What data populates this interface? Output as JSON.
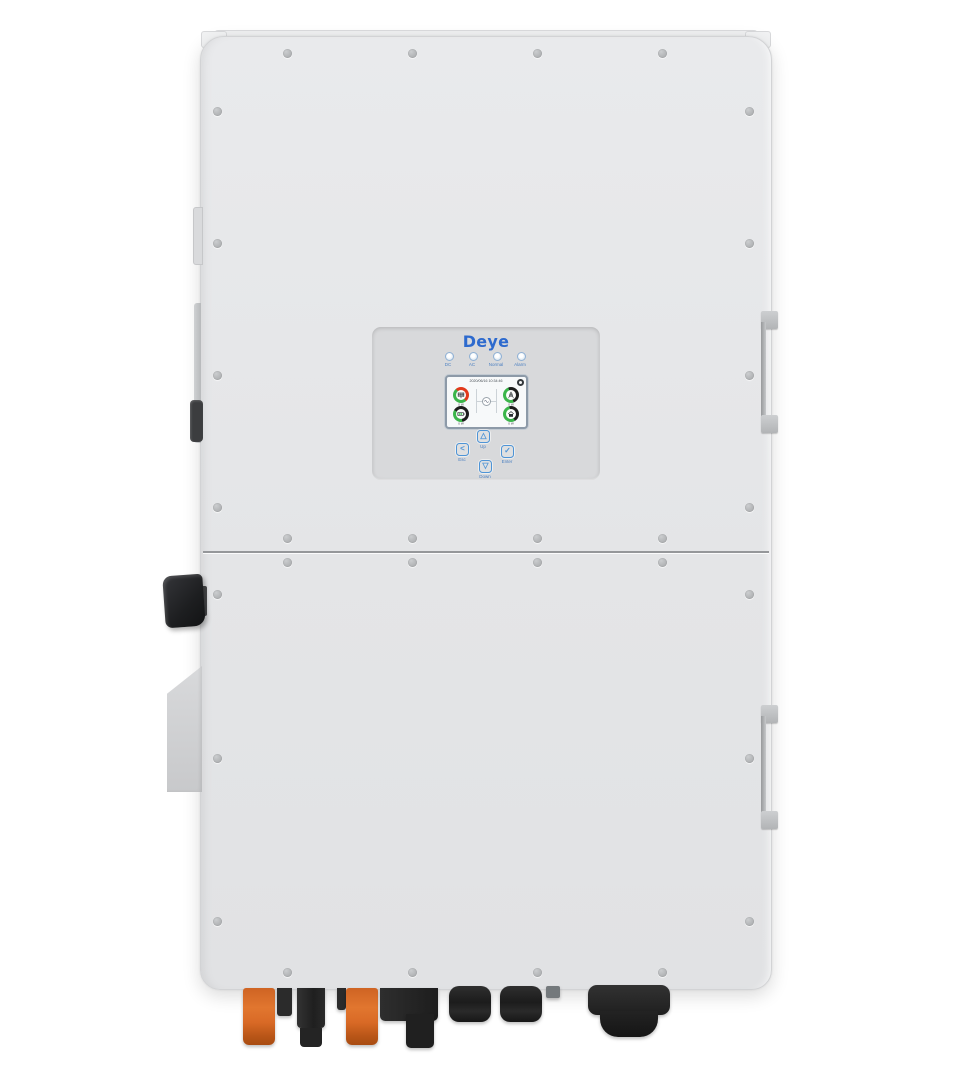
{
  "brand": {
    "logo_text": "Deye",
    "logo_color": "#2d6ace"
  },
  "indicator_leds": [
    {
      "label": "DC"
    },
    {
      "label": "AC"
    },
    {
      "label": "Normal"
    },
    {
      "label": "Alarm"
    }
  ],
  "lcd": {
    "datetime": "2020/06/16 10:34:46",
    "gauges": [
      {
        "name": "pv",
        "icon": "solar-panel-icon",
        "value": "0 W",
        "ring": {
          "from": -40,
          "c1": "#e2391b",
          "p1": 50,
          "c2": "#3bb54a"
        }
      },
      {
        "name": "grid",
        "icon": "grid-tower-icon",
        "value": "0 W",
        "ring": {
          "from": 160,
          "c1": "#3bb54a",
          "p1": 50,
          "c2": "#1c1c1c"
        }
      },
      {
        "name": "battery",
        "icon": "battery-icon",
        "value": "0 W",
        "ring": {
          "from": 170,
          "c1": "#3bb54a",
          "p1": 36,
          "c2": "#1c1c1c"
        }
      },
      {
        "name": "load",
        "icon": "home-load-icon",
        "value": "0 W",
        "ring": {
          "from": 150,
          "c1": "#3bb54a",
          "p1": 55,
          "c2": "#1c1c1c"
        }
      }
    ]
  },
  "buttons": [
    {
      "id": "up",
      "label": "Up",
      "glyph": "△"
    },
    {
      "id": "esc",
      "label": "Esc",
      "glyph": "<"
    },
    {
      "id": "enter",
      "label": "Enter",
      "glyph": "✓"
    },
    {
      "id": "down",
      "label": "Down",
      "glyph": "▽"
    }
  ],
  "hardware": {
    "screws": {
      "inner_columns_x": [
        287,
        412,
        537,
        662
      ],
      "inner_rows_y": [
        53,
        538,
        562,
        972
      ],
      "side_columns_x": [
        217,
        749
      ],
      "side_upper_rows_y": [
        111,
        243,
        375,
        507
      ],
      "side_lower_rows_y": [
        594,
        758,
        921
      ]
    },
    "connector_names": [
      "pv-connector-orange-1",
      "pv-connector-stub-1",
      "pv-connector-black",
      "pv-connector-stub-2",
      "pv-connector-orange-2",
      "terminal-block",
      "terminal-block-lower",
      "cable-gland-1",
      "cable-gland-2",
      "cable-stub",
      "main-cable-gland"
    ]
  },
  "colors": {
    "case": "#e4e5e7",
    "panel": "#d8d9db",
    "accent_blue": "#4e94d6",
    "ring_green": "#3bb54a",
    "ring_red": "#e2391b",
    "ring_dark": "#1c1c1c",
    "connector_orange": "#d96a26"
  }
}
